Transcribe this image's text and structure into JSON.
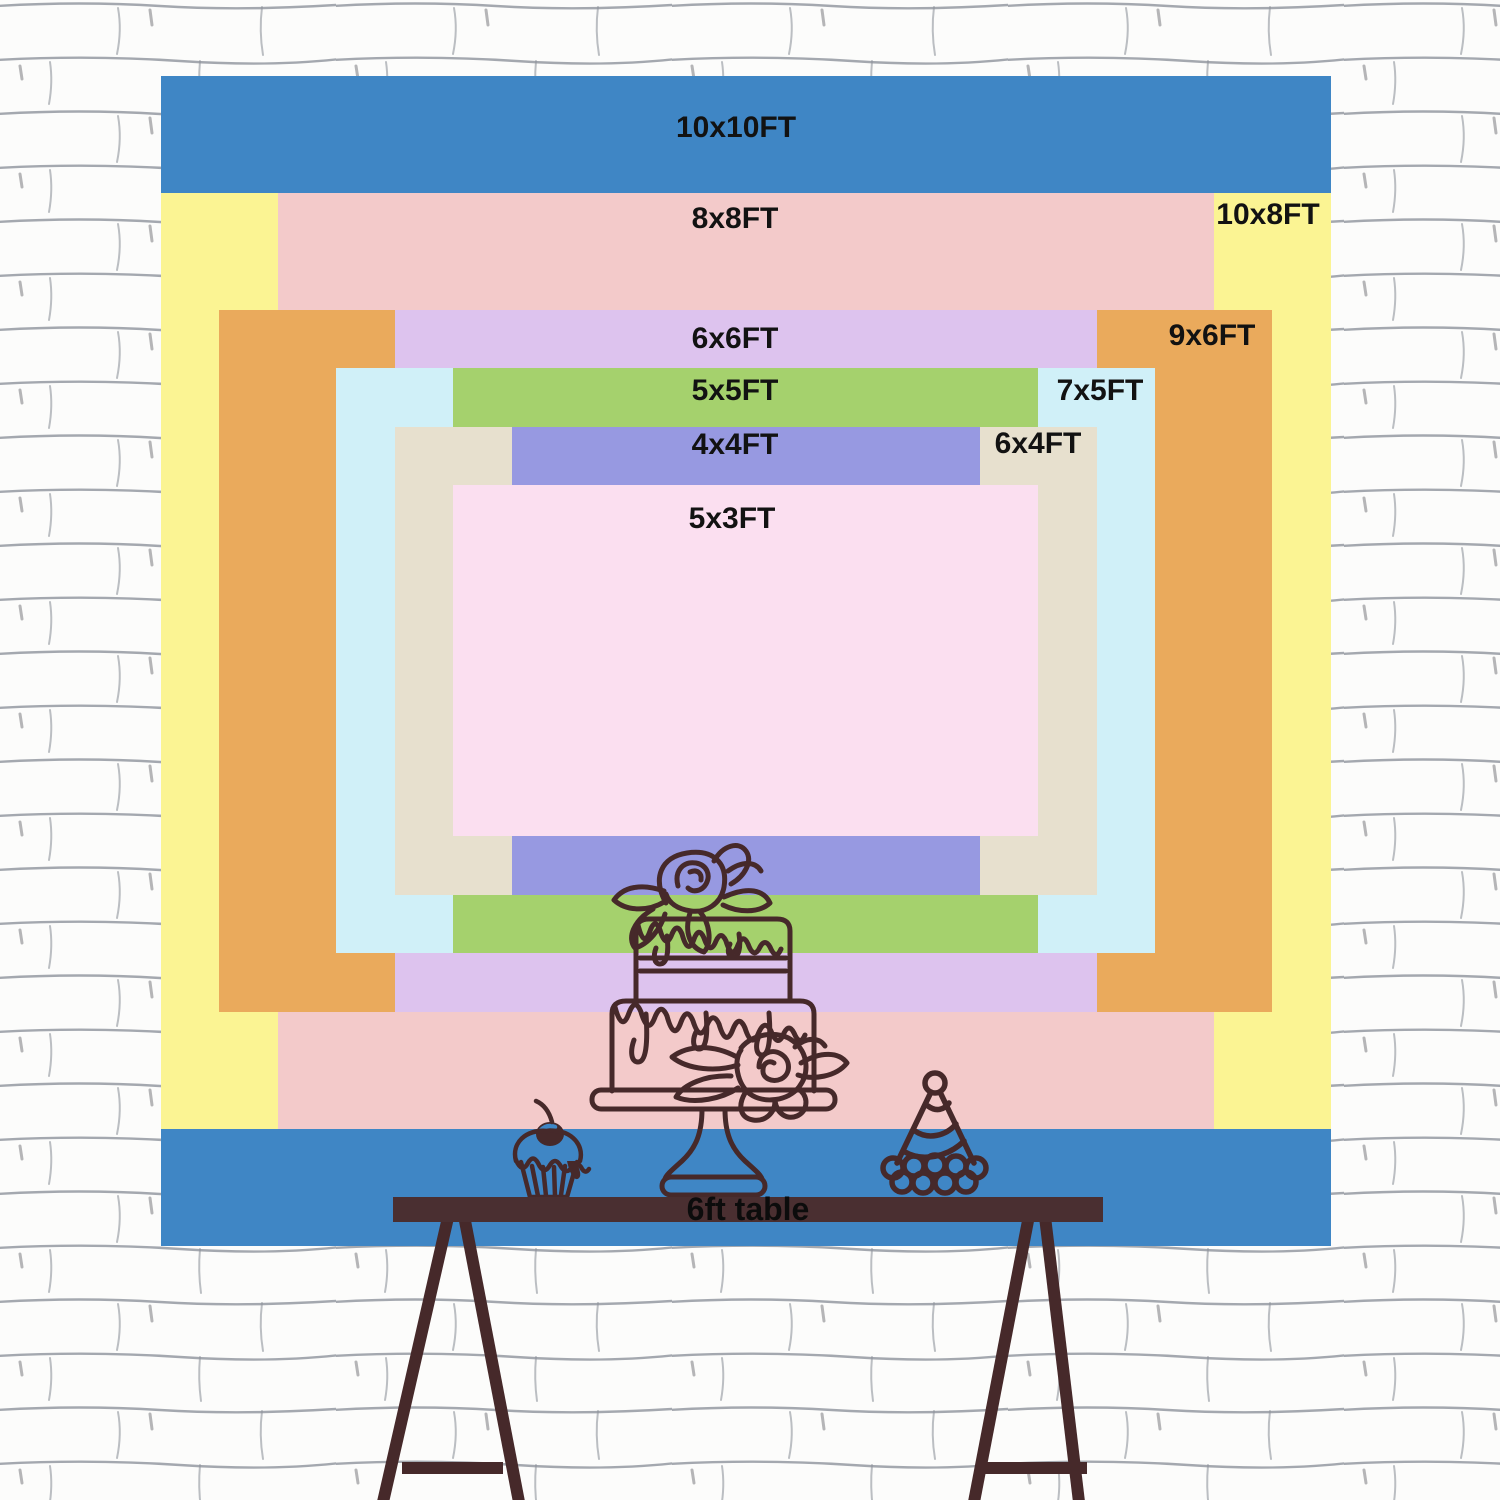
{
  "title": "backdrop size comparison chart",
  "sizes": {
    "s10x10": {
      "label": "10x10FT",
      "width_ft": 10,
      "height_ft": 10,
      "color": "#3f86c5"
    },
    "s10x8": {
      "label": "10x8FT",
      "width_ft": 10,
      "height_ft": 8,
      "color": "#fbf493"
    },
    "s8x8": {
      "label": "8x8FT",
      "width_ft": 8,
      "height_ft": 8,
      "color": "#f3caca"
    },
    "s9x6": {
      "label": "9x6FT",
      "width_ft": 9,
      "height_ft": 6,
      "color": "#eaaa5c"
    },
    "s6x6": {
      "label": "6x6FT",
      "width_ft": 6,
      "height_ft": 6,
      "color": "#ddc3ee"
    },
    "s7x5": {
      "label": "7x5FT",
      "width_ft": 7,
      "height_ft": 5,
      "color": "#d0f0f8"
    },
    "s5x5": {
      "label": "5x5FT",
      "width_ft": 5,
      "height_ft": 5,
      "color": "#a5d16d"
    },
    "s6x4": {
      "label": "6x4FT",
      "width_ft": 6,
      "height_ft": 4,
      "color": "#e7e0ce"
    },
    "s4x4": {
      "label": "4x4FT",
      "width_ft": 4,
      "height_ft": 4,
      "color": "#9799e1"
    },
    "s5x3": {
      "label": "5x3FT",
      "width_ft": 5,
      "height_ft": 3,
      "color": "#fbdff0"
    }
  },
  "table": {
    "label": "6ft table",
    "color": "#4a2f31"
  },
  "illustration": {
    "ink_color": "#46292a",
    "items": [
      "tiered-cake-icon",
      "cupcake-icon",
      "party-hat-icon",
      "trestle-table-legs"
    ]
  },
  "wall": {
    "line_color": "#8f949c",
    "base_color": "#fcfcfb"
  }
}
